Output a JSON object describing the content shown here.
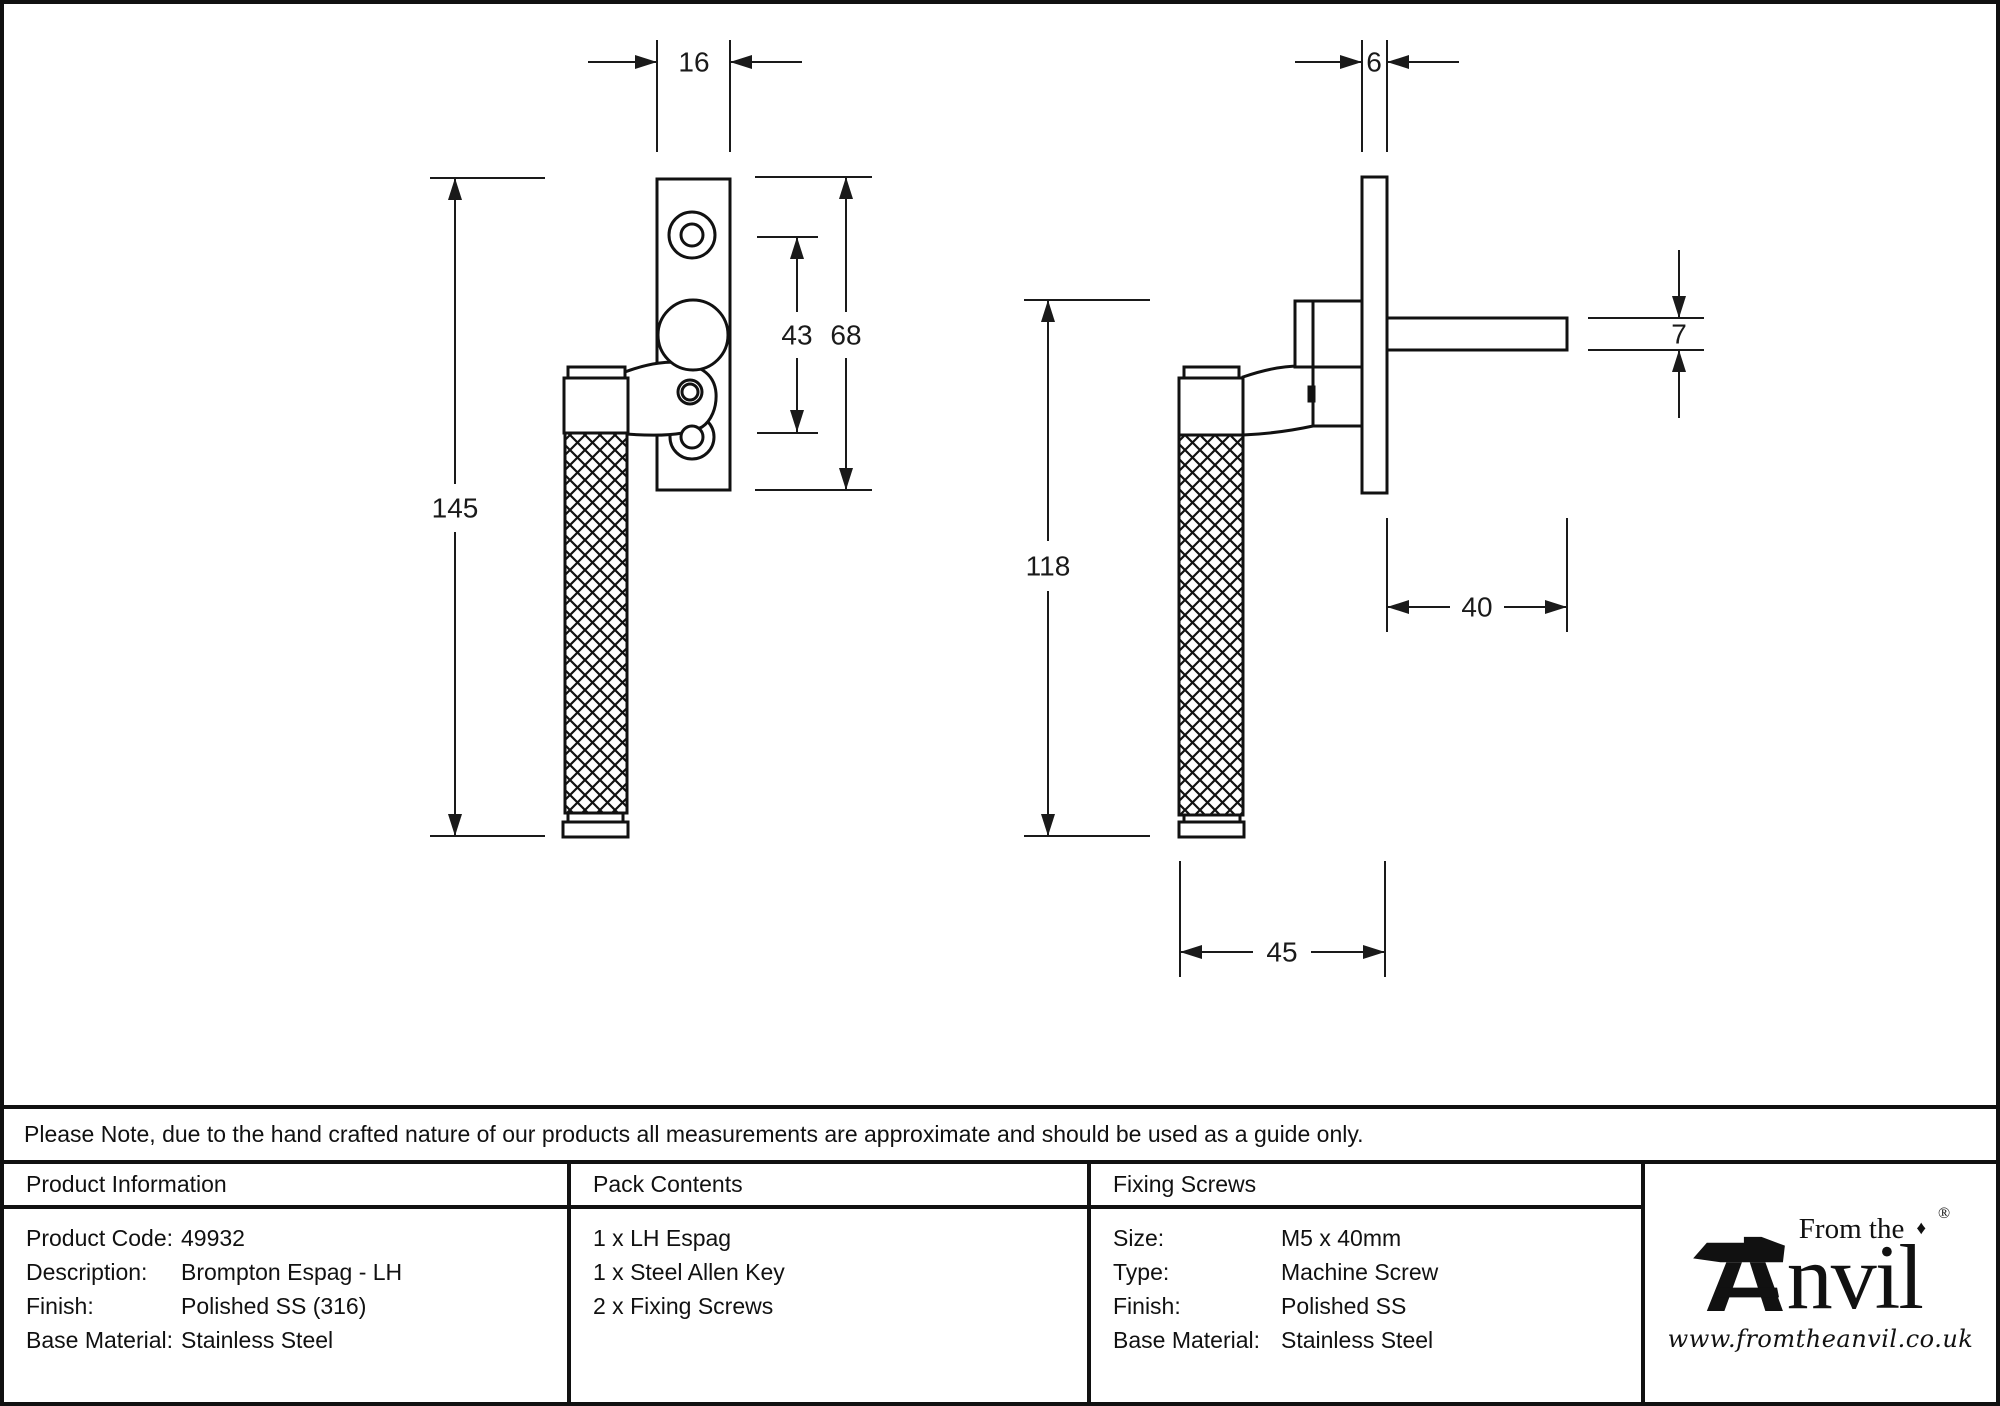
{
  "note": "Please Note, due to the hand crafted nature of our products all measurements are approximate and should be used as a guide only.",
  "drawing": {
    "dims": {
      "front_width": "16",
      "front_length": "145",
      "front_hole_spacing": "43",
      "front_plate_height": "68",
      "side_plate_thickness": "6",
      "side_handle_length": "118",
      "side_spindle_height": "7",
      "side_spindle_length": "40",
      "side_depth": "45"
    },
    "line_color": "#111111",
    "background": "#ffffff"
  },
  "table": {
    "product_information": {
      "title": "Product Information",
      "rows": [
        {
          "label": "Product Code:",
          "value": "49932"
        },
        {
          "label": "Description:",
          "value": "Brompton Espag - LH"
        },
        {
          "label": "Finish:",
          "value": "Polished SS (316)"
        },
        {
          "label": "Base Material:",
          "value": "Stainless Steel"
        }
      ]
    },
    "pack_contents": {
      "title": "Pack Contents",
      "items": [
        "1 x LH Espag",
        "1 x Steel Allen Key",
        "2 x Fixing Screws"
      ]
    },
    "fixing_screws": {
      "title": "Fixing Screws",
      "rows": [
        {
          "label": "Size:",
          "value": "M5 x 40mm"
        },
        {
          "label": "Type:",
          "value": "Machine Screw"
        },
        {
          "label": "Finish:",
          "value": "Polished SS"
        },
        {
          "label": "Base Material:",
          "value": "Stainless Steel"
        }
      ]
    }
  },
  "logo": {
    "prefix": "From the",
    "diamond": "♦",
    "registered": "®",
    "name_rest": "nvil",
    "website": "www.fromtheanvil.co.uk"
  }
}
